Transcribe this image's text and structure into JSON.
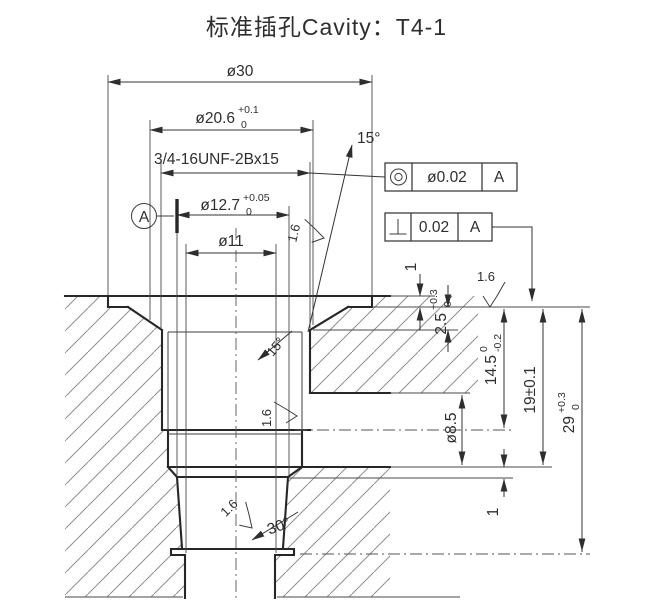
{
  "title": "标准插孔Cavity：T4-1",
  "dims": {
    "dia30": "ø30",
    "dia206": {
      "v": "ø20.6",
      "up": "+0.1",
      "dn": "0"
    },
    "thread": "3/4-16UNF-2Bx15",
    "dia127": {
      "v": "ø12.7",
      "up": "+0.05",
      "dn": "0"
    },
    "dia11": "ø11",
    "taper_angle": "15°",
    "mouth_angle": "15°",
    "neck_angle": "30°",
    "flange_depth": "1",
    "seat_depth": {
      "v": "2.5",
      "up": "+0.3",
      "dn": "0"
    },
    "port_dia": "ø8.5",
    "port_center_depth": {
      "v": "14.5",
      "up": "0",
      "dn": "-0.2"
    },
    "floor_depth": "19±0.1",
    "total_depth": {
      "v": "29",
      "up": "+0.3",
      "dn": "0"
    },
    "floor_step": "1"
  },
  "roughness": {
    "seat": "1.6",
    "bore": "1.6",
    "neck": "1.6",
    "taper": "1.6"
  },
  "datum": {
    "label": "A"
  },
  "fcf": {
    "concentricity": {
      "symbol": "concentricity",
      "value": "ø0.02",
      "datum": "A"
    },
    "perpendicularity": {
      "symbol": "perpendicularity",
      "value": "0.02",
      "datum": "A"
    }
  }
}
